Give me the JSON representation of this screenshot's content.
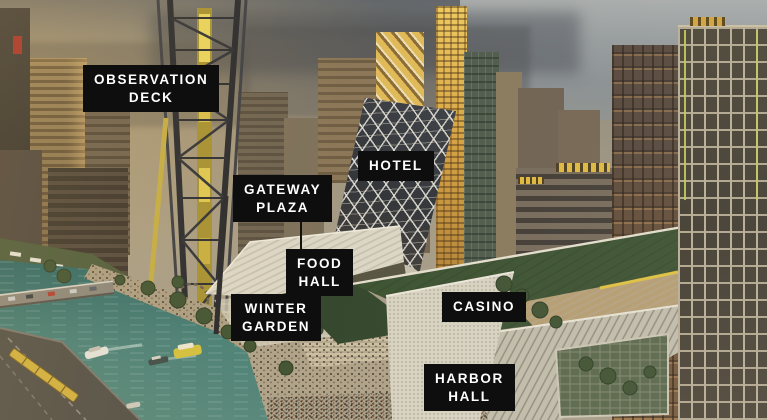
{
  "scene": {
    "description": "Aerial architectural rendering of a riverfront casino district at sunset with annotated venues"
  },
  "labels": {
    "observation_deck": "OBSERVATION\nDECK",
    "hotel": "HOTEL",
    "gateway_plaza": "GATEWAY\nPLAZA",
    "food_hall": "FOOD\nHALL",
    "winter_garden": "WINTER\nGARDEN",
    "casino": "CASINO",
    "harbor_hall": "HARBOR\nHALL"
  },
  "colors": {
    "label_background": "#0e0e0e",
    "label_text": "#ffffff",
    "river_water": "#3c7572",
    "green_roof": "#3a512f",
    "gold_tower": "#d9a440",
    "tower_yellow": "#e2c94f",
    "sky_haze": "#97907e",
    "facade_white": "#dcd6c5"
  }
}
